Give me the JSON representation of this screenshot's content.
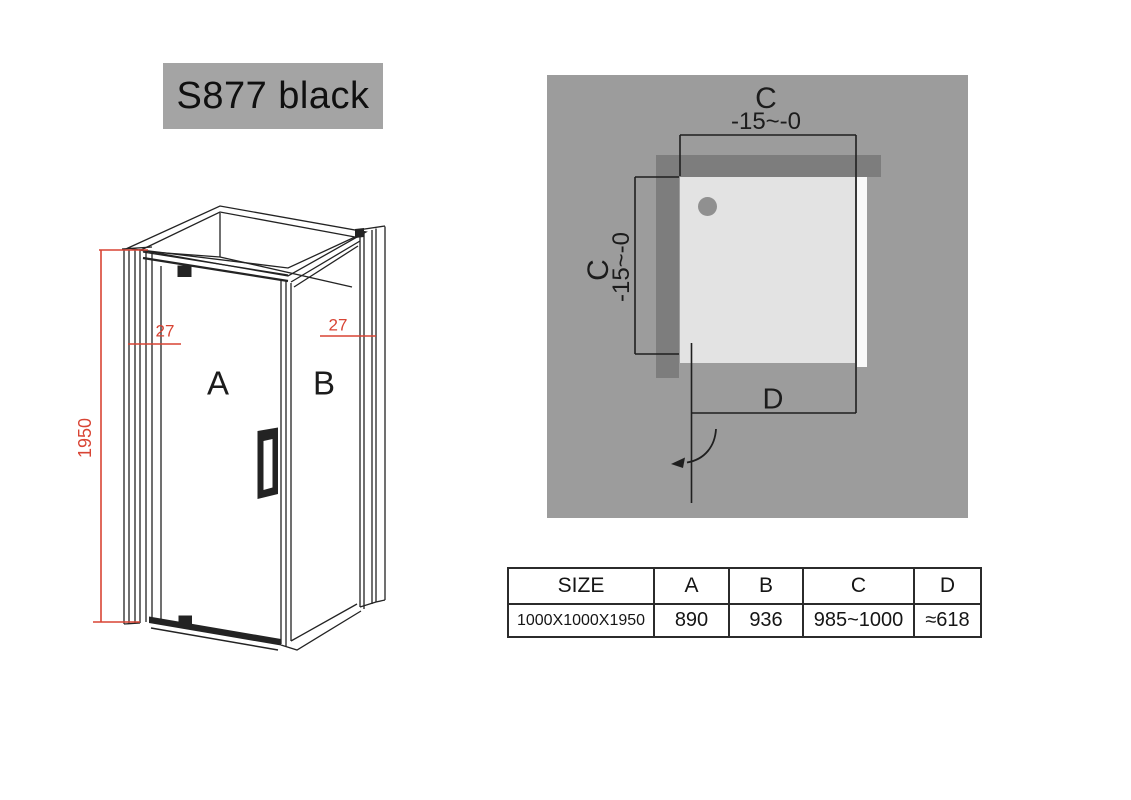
{
  "title": {
    "label": "S877 black"
  },
  "front_view": {
    "panel_a_label": "A",
    "panel_b_label": "B",
    "dim_height": "1950",
    "dim_left_profile": "27",
    "dim_right_profile": "27"
  },
  "top_view": {
    "dim_c_top": {
      "label": "C",
      "range": "-15~-0"
    },
    "dim_c_left": {
      "label": "C",
      "range": "-15~-0"
    },
    "dim_d": {
      "label": "D"
    }
  },
  "size_table": {
    "headers": [
      "SIZE",
      "A",
      "B",
      "C",
      "D"
    ],
    "rows": [
      [
        "1000X1000X1950",
        "890",
        "936",
        "985~1000",
        "≈618"
      ]
    ]
  },
  "colors": {
    "title_bg": "#a4a4a4",
    "panel_bg": "#9c9c9c",
    "wall_band": "#7d7d7d",
    "tray": "#e3e3e3",
    "drain": "#909090",
    "dimension_red": "#d84434",
    "line_black": "#232323"
  }
}
